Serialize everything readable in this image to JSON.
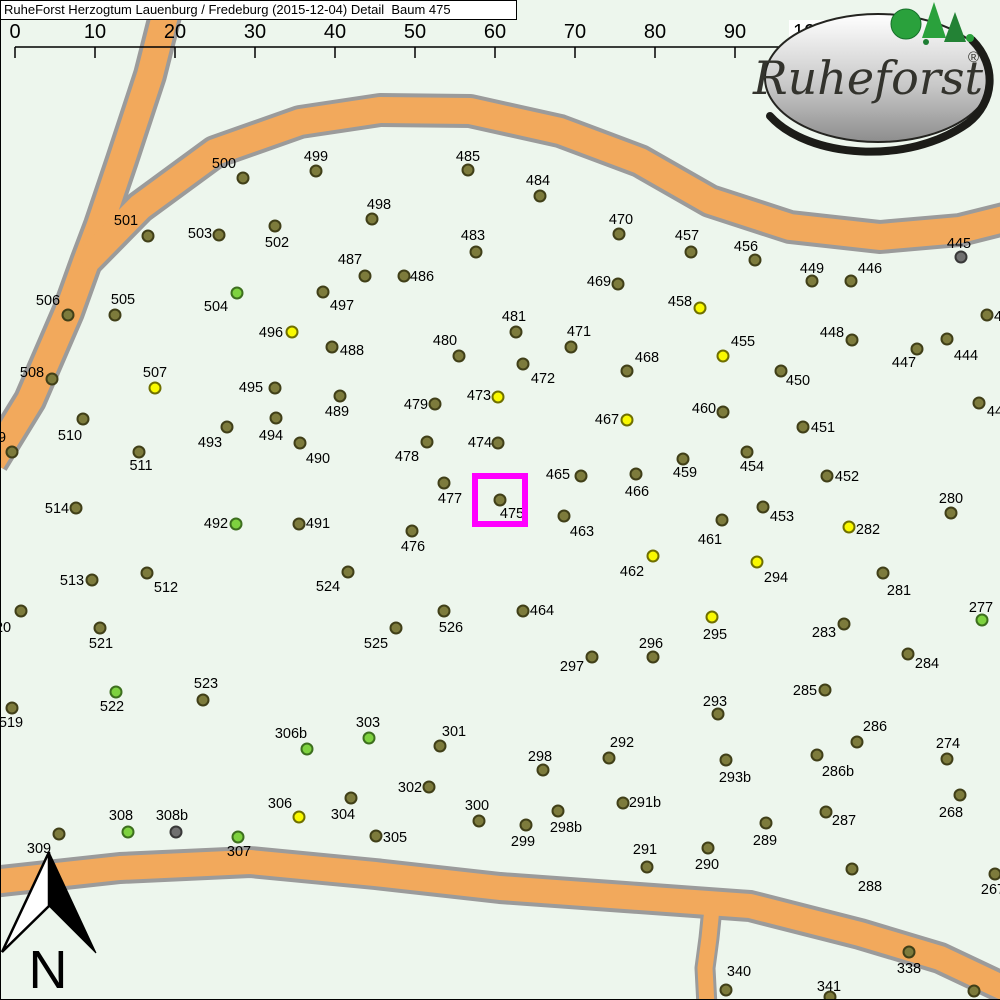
{
  "header": {
    "title": "RuheForst Herzogtum Lauenburg / Fredeburg (2015-12-04) Detail  Baum 475"
  },
  "scale": {
    "line_y": 47,
    "tick_bottom": 58,
    "ticks": [
      {
        "t": "0",
        "x": 15
      },
      {
        "t": "10",
        "x": 95
      },
      {
        "t": "20",
        "x": 175
      },
      {
        "t": "30",
        "x": 255
      },
      {
        "t": "40",
        "x": 335
      },
      {
        "t": "50",
        "x": 415
      },
      {
        "t": "60",
        "x": 495
      },
      {
        "t": "70",
        "x": 575
      },
      {
        "t": "80",
        "x": 655
      },
      {
        "t": "90",
        "x": 735
      },
      {
        "t": "100m",
        "x": 815,
        "box": true
      }
    ]
  },
  "compass": {
    "label": "N"
  },
  "logo": {
    "text": "Ruheforst",
    "reg": "®"
  },
  "highlight": {
    "label": "475",
    "x": 475,
    "y": 476,
    "w": 50,
    "h": 48,
    "color": "#ff00ff"
  },
  "colors": {
    "background": "#edf6ed",
    "road_fill": "#f2a95c",
    "road_casing": "#9b9b9b",
    "border": "#000000"
  },
  "dot_styles": {
    "o": {
      "fill": "#7d7b3c",
      "stroke": "#403f18"
    },
    "y": {
      "fill": "#f9f900",
      "stroke": "#6f6f00"
    },
    "g": {
      "fill": "#7ed23f",
      "stroke": "#3d6f1e"
    },
    "gr": {
      "fill": "#707070",
      "stroke": "#383838"
    }
  },
  "roads": [
    {
      "name": "road-northwest-diagonal",
      "w": 26,
      "cw": 34,
      "points": [
        [
          172,
          -12
        ],
        [
          150,
          75
        ],
        [
          122,
          160
        ],
        [
          100,
          225
        ],
        [
          86,
          262
        ],
        [
          68,
          312
        ],
        [
          30,
          400
        ],
        [
          -8,
          462
        ]
      ]
    },
    {
      "name": "road-north",
      "w": 26,
      "cw": 34,
      "points": [
        [
          84,
          264
        ],
        [
          140,
          207
        ],
        [
          215,
          152
        ],
        [
          300,
          122
        ],
        [
          380,
          110
        ],
        [
          470,
          111
        ],
        [
          560,
          131
        ],
        [
          640,
          161
        ],
        [
          710,
          201
        ],
        [
          790,
          227
        ],
        [
          880,
          237
        ],
        [
          960,
          230
        ],
        [
          1012,
          217
        ]
      ]
    },
    {
      "name": "road-south-branch",
      "w": 15,
      "cw": 21,
      "points": [
        [
          713,
          898
        ],
        [
          709,
          938
        ],
        [
          705,
          968
        ],
        [
          707,
          1006
        ]
      ]
    },
    {
      "name": "road-south",
      "w": 24,
      "cw": 32,
      "points": [
        [
          -8,
          882
        ],
        [
          120,
          868
        ],
        [
          250,
          862
        ],
        [
          375,
          874
        ],
        [
          500,
          888
        ],
        [
          625,
          897
        ],
        [
          750,
          906
        ],
        [
          860,
          934
        ],
        [
          940,
          958
        ],
        [
          1012,
          992
        ]
      ]
    }
  ],
  "trees": {
    "fields": [
      "label",
      "dot_x",
      "dot_y",
      "label_x",
      "label_y",
      "color"
    ],
    "rows": [
      [
        "500",
        243,
        178,
        224,
        163,
        "o"
      ],
      [
        "501",
        148,
        236,
        126,
        220,
        "o"
      ],
      [
        "503",
        219,
        235,
        200,
        233,
        "o"
      ],
      [
        "502",
        275,
        226,
        277,
        242,
        "o"
      ],
      [
        "499",
        316,
        171,
        316,
        156,
        "o"
      ],
      [
        "498",
        372,
        219,
        379,
        204,
        "o"
      ],
      [
        "485",
        468,
        170,
        468,
        156,
        "o"
      ],
      [
        "484",
        540,
        196,
        538,
        180,
        "o"
      ],
      [
        "483",
        476,
        252,
        473,
        235,
        "o"
      ],
      [
        "487",
        365,
        276,
        350,
        259,
        "o"
      ],
      [
        "486",
        404,
        276,
        422,
        276,
        "o"
      ],
      [
        "470",
        619,
        234,
        621,
        219,
        "o"
      ],
      [
        "457",
        691,
        252,
        687,
        235,
        "o"
      ],
      [
        "469",
        618,
        284,
        599,
        281,
        "o"
      ],
      [
        "458",
        700,
        308,
        680,
        301,
        "y"
      ],
      [
        "456",
        755,
        260,
        746,
        246,
        "o"
      ],
      [
        "449",
        812,
        281,
        812,
        268,
        "o"
      ],
      [
        "446",
        851,
        281,
        870,
        268,
        "o"
      ],
      [
        "445",
        961,
        257,
        959,
        243,
        "gr"
      ],
      [
        "448",
        852,
        340,
        832,
        332,
        "o"
      ],
      [
        "447",
        917,
        349,
        904,
        362,
        "o"
      ],
      [
        "444",
        947,
        339,
        966,
        355,
        "o"
      ],
      [
        "4",
        987,
        315,
        998,
        316,
        "o"
      ],
      [
        "44",
        979,
        403,
        995,
        411,
        "o"
      ],
      [
        "506",
        68,
        315,
        48,
        300,
        "o"
      ],
      [
        "505",
        115,
        315,
        123,
        299,
        "o"
      ],
      [
        "504",
        237,
        293,
        216,
        306,
        "g"
      ],
      [
        "497",
        323,
        292,
        342,
        305,
        "o"
      ],
      [
        "496",
        292,
        332,
        271,
        332,
        "y"
      ],
      [
        "488",
        332,
        347,
        352,
        350,
        "o"
      ],
      [
        "480",
        459,
        356,
        445,
        340,
        "o"
      ],
      [
        "481",
        516,
        332,
        514,
        316,
        "o"
      ],
      [
        "471",
        571,
        347,
        579,
        331,
        "o"
      ],
      [
        "455",
        723,
        356,
        743,
        341,
        "y"
      ],
      [
        "468",
        627,
        371,
        647,
        357,
        "o"
      ],
      [
        "472",
        523,
        364,
        543,
        378,
        "o"
      ],
      [
        "508",
        52,
        379,
        32,
        372,
        "o"
      ],
      [
        "507",
        155,
        388,
        155,
        372,
        "y"
      ],
      [
        "495",
        275,
        388,
        251,
        387,
        "o"
      ],
      [
        "489",
        340,
        396,
        337,
        411,
        "o"
      ],
      [
        "479",
        435,
        404,
        416,
        404,
        "o"
      ],
      [
        "473",
        498,
        397,
        479,
        395,
        "y"
      ],
      [
        "467",
        627,
        420,
        607,
        419,
        "y"
      ],
      [
        "460",
        723,
        412,
        704,
        408,
        "o"
      ],
      [
        "450",
        781,
        371,
        798,
        380,
        "o"
      ],
      [
        "510",
        83,
        419,
        70,
        435,
        "o"
      ],
      [
        "493",
        227,
        427,
        210,
        442,
        "o"
      ],
      [
        "494",
        276,
        418,
        271,
        435,
        "o"
      ],
      [
        "490",
        300,
        443,
        318,
        458,
        "o"
      ],
      [
        "478",
        427,
        442,
        407,
        456,
        "o"
      ],
      [
        "474",
        498,
        443,
        480,
        442,
        "o"
      ],
      [
        "511",
        139,
        452,
        141,
        465,
        "o"
      ],
      [
        "451",
        803,
        427,
        823,
        427,
        "o"
      ],
      [
        "509",
        12,
        452,
        -6,
        437,
        "o"
      ],
      [
        "454",
        747,
        452,
        752,
        466,
        "o"
      ],
      [
        "459",
        683,
        459,
        685,
        472,
        "o"
      ],
      [
        "466",
        636,
        474,
        637,
        491,
        "o"
      ],
      [
        "465",
        581,
        476,
        558,
        474,
        "o"
      ],
      [
        "477",
        444,
        483,
        450,
        498,
        "o"
      ],
      [
        "475",
        500,
        500,
        512,
        513,
        "o"
      ],
      [
        "452",
        827,
        476,
        847,
        476,
        "o"
      ],
      [
        "280",
        951,
        513,
        951,
        498,
        "o"
      ],
      [
        "453",
        763,
        507,
        782,
        516,
        "o"
      ],
      [
        "282",
        849,
        527,
        868,
        529,
        "y"
      ],
      [
        "514",
        76,
        508,
        57,
        508,
        "o"
      ],
      [
        "492",
        236,
        524,
        216,
        523,
        "g"
      ],
      [
        "491",
        299,
        524,
        318,
        523,
        "o"
      ],
      [
        "463",
        564,
        516,
        582,
        531,
        "o"
      ],
      [
        "461",
        722,
        520,
        710,
        539,
        "o"
      ],
      [
        "476",
        412,
        531,
        413,
        546,
        "o"
      ],
      [
        "462",
        653,
        556,
        632,
        571,
        "y"
      ],
      [
        "294",
        757,
        562,
        776,
        577,
        "y"
      ],
      [
        "513",
        92,
        580,
        72,
        580,
        "o"
      ],
      [
        "512",
        147,
        573,
        166,
        587,
        "o"
      ],
      [
        "524",
        348,
        572,
        328,
        586,
        "o"
      ],
      [
        "281",
        883,
        573,
        899,
        590,
        "o"
      ],
      [
        "520",
        21,
        611,
        -1,
        627,
        "o"
      ],
      [
        "521",
        100,
        628,
        101,
        643,
        "o"
      ],
      [
        "464",
        523,
        611,
        542,
        610,
        "o"
      ],
      [
        "295",
        712,
        617,
        715,
        634,
        "y"
      ],
      [
        "283",
        844,
        624,
        824,
        632,
        "o"
      ],
      [
        "277",
        982,
        620,
        981,
        607,
        "g"
      ],
      [
        "296",
        653,
        657,
        651,
        643,
        "o"
      ],
      [
        "297",
        592,
        657,
        572,
        666,
        "o"
      ],
      [
        "284",
        908,
        654,
        927,
        663,
        "o"
      ],
      [
        "525",
        396,
        628,
        376,
        643,
        "o"
      ],
      [
        "526",
        444,
        611,
        451,
        627,
        "o"
      ],
      [
        "523",
        203,
        700,
        206,
        683,
        "o"
      ],
      [
        "522",
        116,
        692,
        112,
        706,
        "g"
      ],
      [
        "519",
        12,
        708,
        11,
        722,
        "o"
      ],
      [
        "285",
        825,
        690,
        805,
        690,
        "o"
      ],
      [
        "303",
        369,
        738,
        368,
        722,
        "g"
      ],
      [
        "306b",
        307,
        749,
        291,
        733,
        "g"
      ],
      [
        "301",
        440,
        746,
        454,
        731,
        "o"
      ],
      [
        "292",
        609,
        758,
        622,
        742,
        "o"
      ],
      [
        "293",
        718,
        714,
        715,
        701,
        "o"
      ],
      [
        "286",
        857,
        742,
        875,
        726,
        "o"
      ],
      [
        "274",
        947,
        759,
        948,
        743,
        "o"
      ],
      [
        "286b",
        817,
        755,
        838,
        771,
        "o"
      ],
      [
        "298",
        543,
        770,
        540,
        756,
        "o"
      ],
      [
        "293b",
        726,
        760,
        735,
        777,
        "o"
      ],
      [
        "291b",
        623,
        803,
        645,
        802,
        "o"
      ],
      [
        "298b",
        558,
        811,
        566,
        827,
        "o"
      ],
      [
        "299",
        526,
        825,
        523,
        841,
        "o"
      ],
      [
        "306",
        299,
        817,
        280,
        803,
        "y"
      ],
      [
        "304",
        351,
        798,
        343,
        814,
        "o"
      ],
      [
        "302",
        429,
        787,
        410,
        787,
        "o"
      ],
      [
        "300",
        479,
        821,
        477,
        805,
        "o"
      ],
      [
        "305",
        376,
        836,
        395,
        837,
        "o"
      ],
      [
        "308",
        128,
        832,
        121,
        815,
        "g"
      ],
      [
        "308b",
        176,
        832,
        172,
        815,
        "gr"
      ],
      [
        "309",
        59,
        834,
        39,
        848,
        "o"
      ],
      [
        "307",
        238,
        837,
        239,
        851,
        "g"
      ],
      [
        "291",
        647,
        867,
        645,
        849,
        "o"
      ],
      [
        "290",
        708,
        848,
        707,
        864,
        "o"
      ],
      [
        "289",
        766,
        823,
        765,
        840,
        "o"
      ],
      [
        "287",
        826,
        812,
        844,
        820,
        "o"
      ],
      [
        "268",
        960,
        795,
        951,
        812,
        "o"
      ],
      [
        "288",
        852,
        869,
        870,
        886,
        "o"
      ],
      [
        "267",
        995,
        874,
        993,
        889,
        "o"
      ],
      [
        "338",
        909,
        952,
        909,
        968,
        "o"
      ],
      [
        "341",
        830,
        997,
        829,
        986,
        "o"
      ],
      [
        "340",
        726,
        990,
        739,
        971,
        "o"
      ],
      [
        "",
        974,
        991,
        974,
        991,
        "o"
      ]
    ]
  }
}
